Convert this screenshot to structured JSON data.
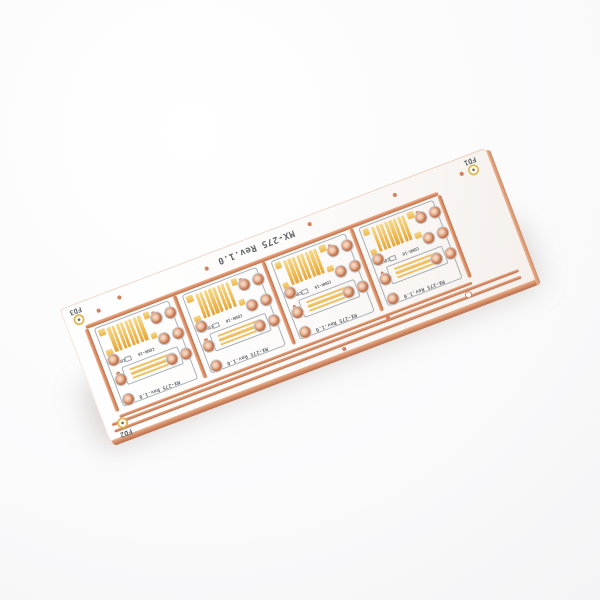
{
  "panel": {
    "silkscreen_title": "MX-275 Rev.1.0",
    "fiducials": {
      "top_left": "FD3",
      "top_right": "FD1",
      "bottom_left": "FD2"
    },
    "module_count": 4
  },
  "module": {
    "silkscreen_title": "MX-275 Rev.1.0",
    "label_component": "CON16",
    "label_connector": "CONN-16",
    "smd_stripe_count": 8,
    "corner_pad_count": 4,
    "strip_count": 3,
    "through_hole_right_count": 6,
    "through_hole_left_count": 3
  },
  "colors": {
    "copper": "#d28560",
    "gold": "#eeb54a",
    "silkscreen_text": "#606468",
    "board": "#ffffff",
    "background": "#f4f4f6"
  }
}
